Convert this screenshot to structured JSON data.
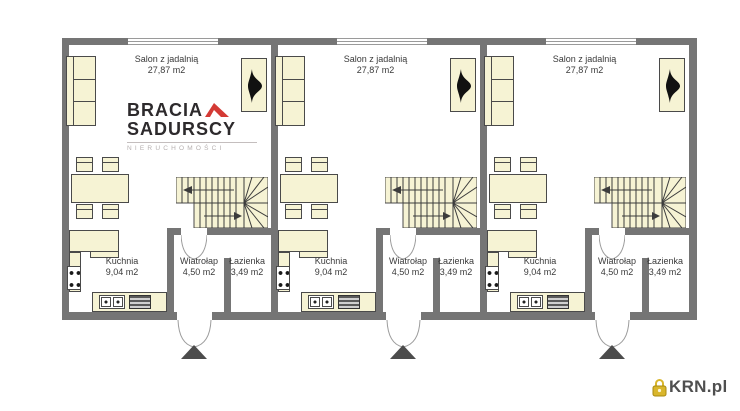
{
  "units": [
    {
      "salon": {
        "name": "Salon z jadalnią",
        "area": "27,87 m2"
      },
      "kuchnia": {
        "name": "Kuchnia",
        "area": "9,04 m2"
      },
      "wiatrolap": {
        "name": "Wiatrołap",
        "area": "4,50 m2"
      },
      "lazienka": {
        "name": "Łazienka",
        "area": "3,49 m2"
      }
    },
    {
      "salon": {
        "name": "Salon z jadalnią",
        "area": "27,87 m2"
      },
      "kuchnia": {
        "name": "Kuchnia",
        "area": "9,04 m2"
      },
      "wiatrolap": {
        "name": "Wiatrołap",
        "area": "4,50 m2"
      },
      "lazienka": {
        "name": "Łazienka",
        "area": "3,49 m2"
      }
    },
    {
      "salon": {
        "name": "Salon z jadalnią",
        "area": "27,87 m2"
      },
      "kuchnia": {
        "name": "Kuchnia",
        "area": "9,04 m2"
      },
      "wiatrolap": {
        "name": "Wiatrołap",
        "area": "4,50 m2"
      },
      "lazienka": {
        "name": "Łazienka",
        "area": "3,49 m2"
      }
    }
  ],
  "watermark": {
    "line1": "BRACIA",
    "line2": "SADURSCY",
    "line3": "NIERUCHOMOŚCI"
  },
  "footer_logo": {
    "text": "KRN.pl"
  },
  "symbols": {
    "entrance_arrow": "up-triangle",
    "fireplace": "flame-icon",
    "lock": "padlock-icon"
  },
  "colors": {
    "wall": "#757575",
    "furniture": "#f6f3d4",
    "outline": "#4a4a4a",
    "brand_red": "#d43a35",
    "brand_dark": "#2d2a2c",
    "brand_gray": "#b5afaf",
    "lock_gold": "#d9b62c",
    "krn_text": "#4f4f4f"
  }
}
